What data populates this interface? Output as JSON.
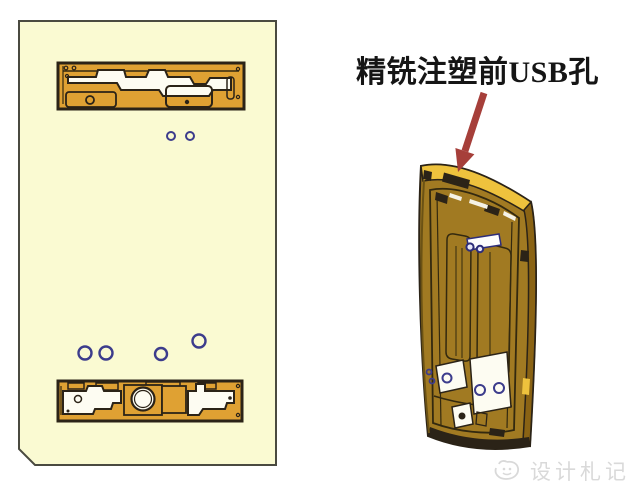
{
  "annotation": {
    "label": "精铣注塑前USB孔"
  },
  "watermark": {
    "text": "设计札记",
    "logo": "swirl-face-icon"
  },
  "colors": {
    "panel_bg": "#fafad2",
    "part_orange": "#dfa133",
    "outline_dark": "#2b2317",
    "hole_blue": "#3c3c8c",
    "arrow_red": "#a63f3a",
    "phone_gold_bright": "#eec23d",
    "phone_face_olive": "#a17a22",
    "phone_side_dark": "#8a6314",
    "watermark_gray": "#d9d9d9",
    "background": "#ffffff"
  }
}
